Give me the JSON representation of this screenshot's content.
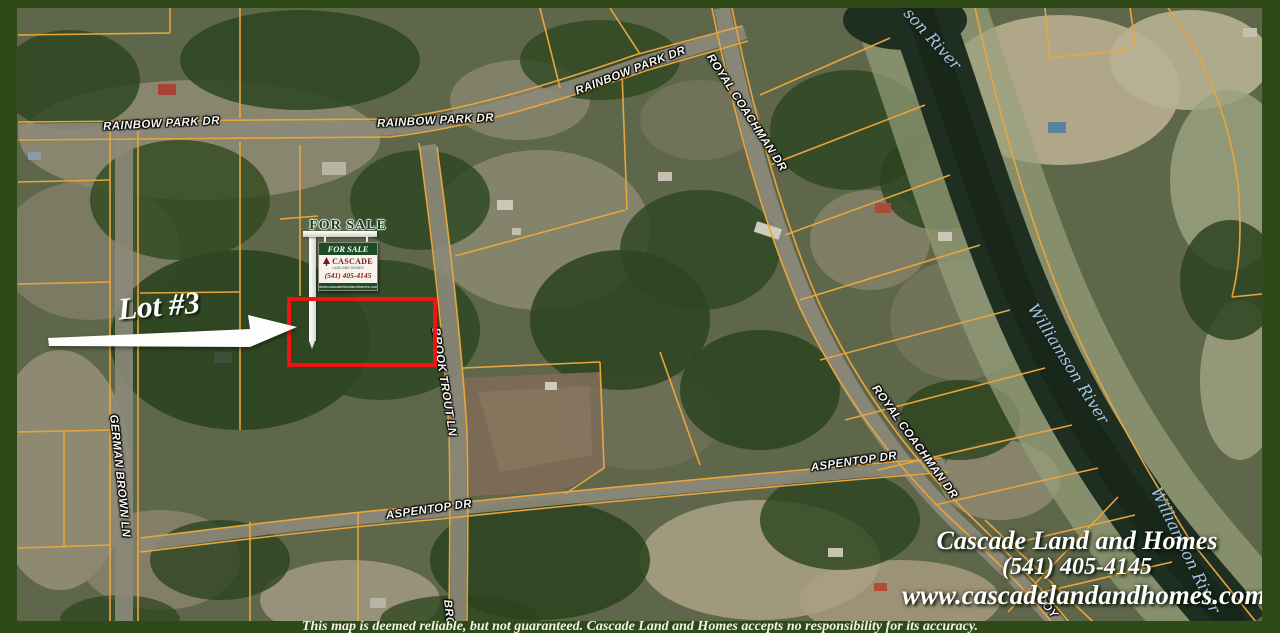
{
  "roads": {
    "rainbow_park_dr_west": "RAINBOW PARK DR",
    "rainbow_park_dr_mid": "RAINBOW PARK DR",
    "rainbow_park_dr_northeast": "RAINBOW PARK DR",
    "royal_coachman_dr_north": "ROYAL COACHMAN DR",
    "royal_coachman_dr_south": "ROYAL COACHMAN DR",
    "royal_coachman_dr_bottom_partial": "ROY",
    "brook_trout_ln": "BROOK TROUT LN",
    "brook_trout_ln_bottom_partial": "BRO",
    "german_brown_ln": "GERMAN BROWN LN",
    "aspentop_dr_west": "ASPENTOP DR",
    "aspentop_dr_east": "ASPENTOP DR"
  },
  "river": {
    "label_top_partial": "son River",
    "label_middle": "Williamson River",
    "label_bottom": "Williamson River"
  },
  "annotation": {
    "lot_label": "Lot #3"
  },
  "sign": {
    "post_title": "FOR SALE",
    "panel_header": "FOR SALE",
    "company": "CASCADE",
    "company_subtitle": "LAND AND HOMES",
    "phone": "(541) 405-4145",
    "panel_footer": "www.cascadelandandhomes.com"
  },
  "branding": {
    "company": "Cascade Land and Homes",
    "phone": "(541) 405-4145",
    "website": "www.cascadelandandhomes.com"
  },
  "disclaimer": "This map is deemed reliable, but not guaranteed. Cascade Land and Homes accepts no responsibility for its accuracy.",
  "colors": {
    "frame_green": "#2d4a17",
    "parcel_line_orange": "#e8a53e",
    "lot_outline_red": "#ee1414",
    "river_label_blue": "#a9c6e6",
    "river_water": "#1e2e21"
  }
}
